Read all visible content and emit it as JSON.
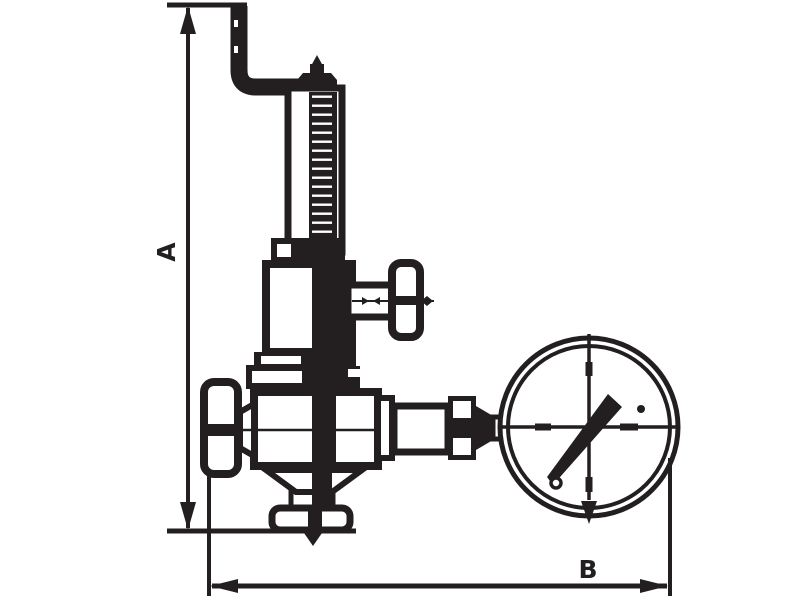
{
  "diagram": {
    "ink_color": "#231f20",
    "background_color": "#ffffff",
    "dimension_labels": {
      "vertical": "A",
      "horizontal": "B"
    },
    "parts": [
      "discharge-pipe",
      "adjusting-cap",
      "threaded-spring-stem",
      "bonnet",
      "side-tee-handle",
      "valve-body",
      "inlet-cap",
      "bottom-outlet",
      "gauge-connection-pipe",
      "pressure-gauge"
    ]
  }
}
